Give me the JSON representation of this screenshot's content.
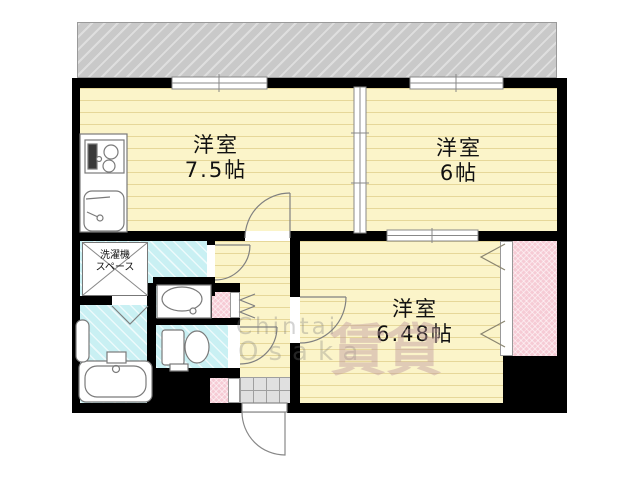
{
  "floorplan": {
    "rooms": [
      {
        "name": "洋室",
        "size": "7.5帖"
      },
      {
        "name": "洋室",
        "size": "6帖"
      },
      {
        "name": "洋室",
        "size": "6.48帖"
      }
    ],
    "laundry": {
      "line1": "洗濯機",
      "line2": "スペース"
    },
    "watermark": {
      "latin1": "Chintai",
      "latin2": "Osaka",
      "kanji": "賃貸"
    },
    "colors": {
      "wall": "#000000",
      "room_floor": "#FBF4C9",
      "wet_area_floor": "#C9F0F3",
      "closet_pink": "#F6CBD5",
      "balcony_gray": "#C9C9C9",
      "entrance_tile": "#E0E0E0"
    }
  }
}
